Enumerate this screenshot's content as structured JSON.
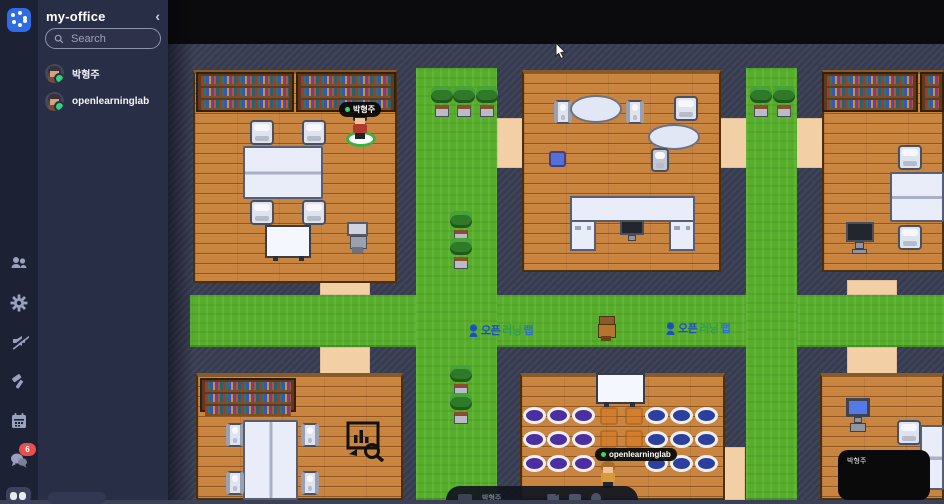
{
  "app": {
    "title": "my-office",
    "collapse_icon": "‹"
  },
  "search": {
    "placeholder": "Search"
  },
  "members": [
    {
      "name": "박형주",
      "status": "online"
    },
    {
      "name": "openlearninglab",
      "status": "online"
    }
  ],
  "rail": {
    "chat_badge": "6",
    "icons": [
      "participants",
      "settings",
      "announce-muted",
      "build",
      "calendar",
      "chat",
      "more"
    ]
  },
  "map": {
    "signs": [
      {
        "p1": "오픈",
        "p2": "러닝",
        "p3": "랩"
      },
      {
        "p1": "오픈",
        "p2": "러닝",
        "p3": "랩"
      }
    ],
    "players": [
      {
        "name": "박형주"
      },
      {
        "name": "openlearninglab"
      }
    ],
    "video_tile": {
      "name": "박형주"
    },
    "toolbar": {
      "user": "박형주"
    }
  },
  "colors": {
    "accent_blue": "#2e6be4",
    "grass": "#56ae2b",
    "floor": "#c9843f",
    "presence_green": "#2fd57a",
    "badge_red": "#e8504e",
    "seat_purple": "#4b2ea0",
    "seat_blue": "#2a3f9e"
  }
}
